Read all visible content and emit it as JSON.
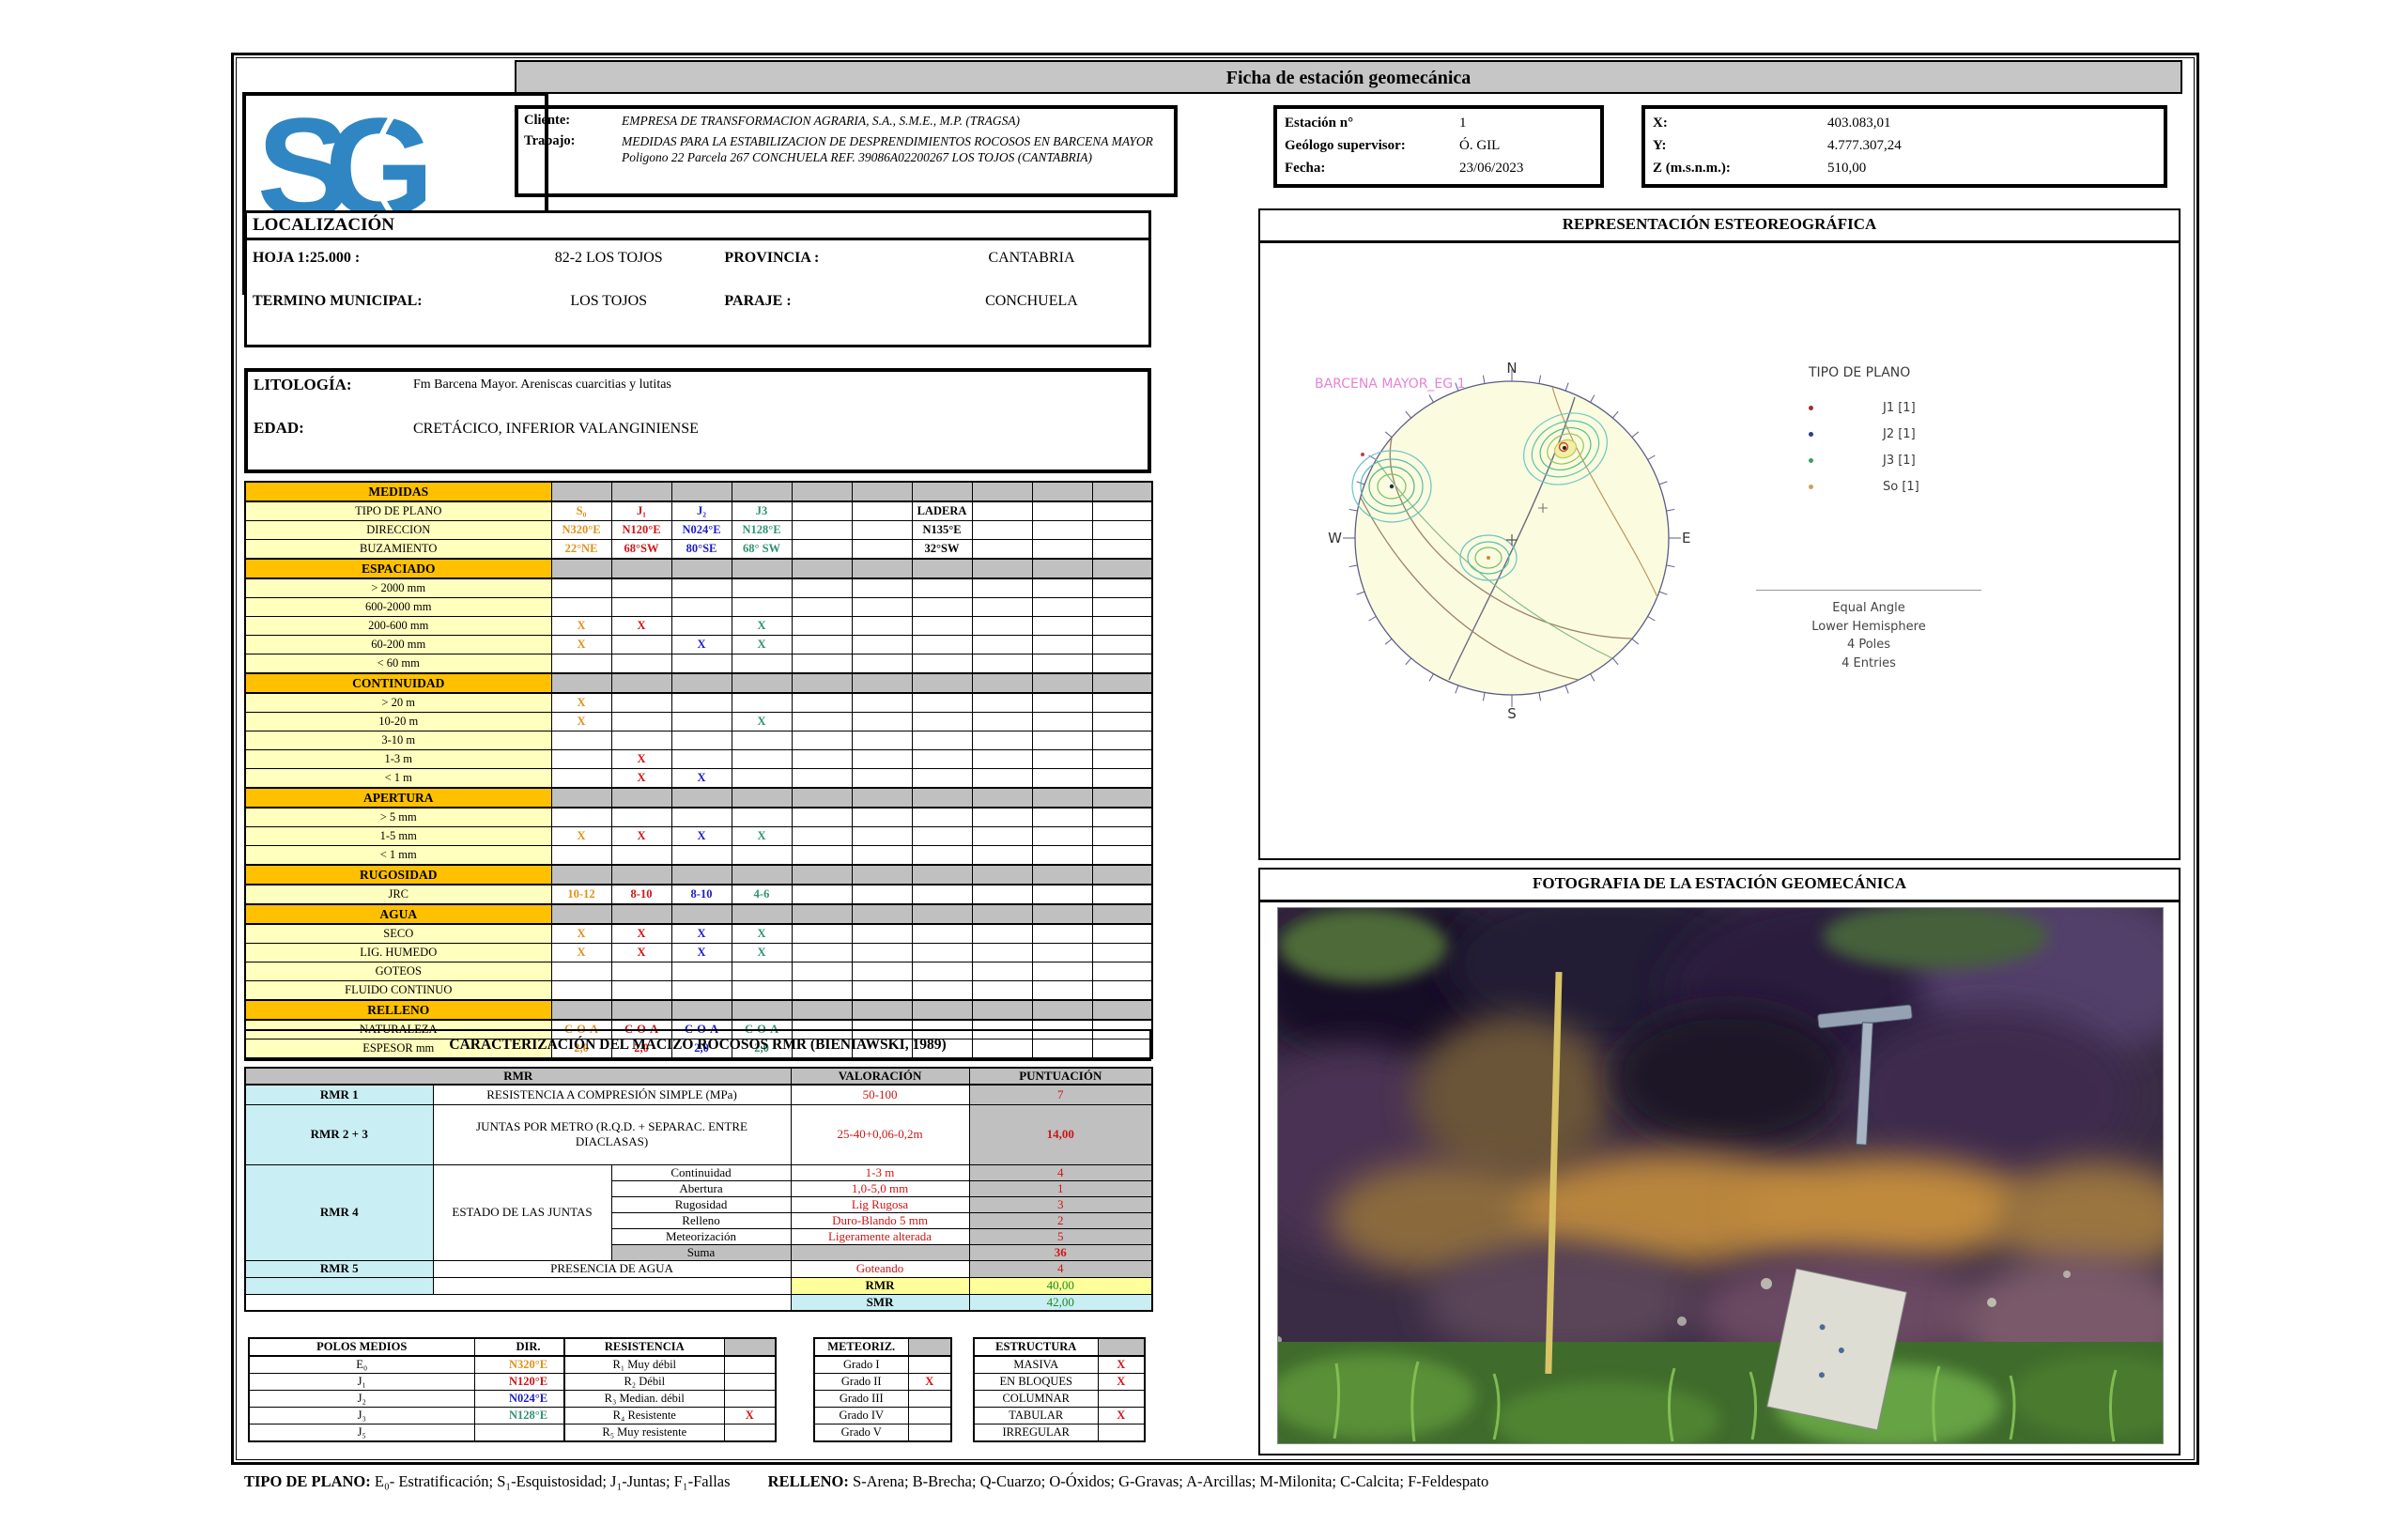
{
  "header": {
    "title": "Ficha de estación geomecánica",
    "logo": {
      "mark": "SG",
      "name": "SONINGEO"
    },
    "client": {
      "cliente_label": "Cliente:",
      "cliente": "EMPRESA DE TRANSFORMACION AGRARIA, S.A., S.M.E., M.P.  (TRAGSA)",
      "trabajo_label": "Trabajo:",
      "trabajo": "MEDIDAS PARA LA ESTABILIZACION DE DESPRENDIMIENTOS ROCOSOS EN BARCENA MAYOR Poligono 22 Parcela 267 CONCHUELA  REF. 39086A02200267 LOS TOJOS (CANTABRIA)"
    },
    "station": [
      [
        "Estación n°",
        "1"
      ],
      [
        "Geólogo supervisor:",
        "Ó. GIL"
      ],
      [
        "Fecha:",
        "23/06/2023"
      ]
    ],
    "coords": [
      [
        "X:",
        "403.083,01"
      ],
      [
        "Y:",
        "4.777.307,24"
      ],
      [
        "Z (m.s.n.m.):",
        "510,00"
      ]
    ]
  },
  "localizacion": {
    "title": "LOCALIZACIÓN",
    "rows": [
      [
        "HOJA 1:25.000 :",
        "82-2 LOS TOJOS",
        "PROVINCIA :",
        "CANTABRIA"
      ],
      [
        "TERMINO MUNICIPAL:",
        "LOS TOJOS",
        "PARAJE :",
        "CONCHUELA"
      ]
    ]
  },
  "litologia": {
    "rows": [
      [
        "LITOLOGÍA:",
        "Fm Barcena Mayor. Areniscas cuarcitias y lutitas"
      ],
      [
        "EDAD:",
        "CRETÁCICO, INFERIOR VALANGINIENSE"
      ]
    ]
  },
  "colors": {
    "o": "#e09018",
    "r": "#cc1616",
    "b": "#1c1cc8",
    "g": "#2e9272",
    "k": "#000000"
  },
  "medidas": {
    "rows": [
      {
        "t": "sec",
        "label": "MEDIDAS"
      },
      {
        "t": "row",
        "label": "TIPO DE PLANO",
        "cells": {
          "0": [
            "S₀",
            "o"
          ],
          "1": [
            "J₁",
            "r"
          ],
          "2": [
            "J₂",
            "b"
          ],
          "3": [
            "J3",
            "g"
          ],
          "6": [
            "LADERA",
            "k"
          ]
        }
      },
      {
        "t": "row",
        "label": "DIRECCION",
        "cells": {
          "0": [
            "N320°E",
            "o"
          ],
          "1": [
            "N120°E",
            "r"
          ],
          "2": [
            "N024°E",
            "b"
          ],
          "3": [
            "N128°E",
            "g"
          ],
          "6": [
            "N135°E",
            "k"
          ]
        }
      },
      {
        "t": "row",
        "label": "BUZAMIENTO",
        "cells": {
          "0": [
            "22°NE",
            "o"
          ],
          "1": [
            "68°SW",
            "r"
          ],
          "2": [
            "80°SE",
            "b"
          ],
          "3": [
            "68° SW",
            "g"
          ],
          "6": [
            "32°SW",
            "k"
          ]
        }
      },
      {
        "t": "sec",
        "label": "ESPACIADO"
      },
      {
        "t": "row",
        "label": "> 2000 mm",
        "cells": {}
      },
      {
        "t": "row",
        "label": "600-2000 mm",
        "cells": {}
      },
      {
        "t": "row",
        "label": "200-600 mm",
        "cells": {
          "0": [
            "X",
            "o"
          ],
          "1": [
            "X",
            "r"
          ],
          "3": [
            "X",
            "g"
          ]
        }
      },
      {
        "t": "row",
        "label": "60-200 mm",
        "cells": {
          "0": [
            "X",
            "o"
          ],
          "2": [
            "X",
            "b"
          ],
          "3": [
            "X",
            "g"
          ]
        }
      },
      {
        "t": "row",
        "label": "< 60 mm",
        "cells": {}
      },
      {
        "t": "sec",
        "label": "CONTINUIDAD"
      },
      {
        "t": "row",
        "label": "> 20 m",
        "cells": {
          "0": [
            "X",
            "o"
          ]
        }
      },
      {
        "t": "row",
        "label": "10-20 m",
        "cells": {
          "0": [
            "X",
            "o"
          ],
          "3": [
            "X",
            "g"
          ]
        }
      },
      {
        "t": "row",
        "label": "3-10 m",
        "cells": {}
      },
      {
        "t": "row",
        "label": "1-3 m",
        "cells": {
          "1": [
            "X",
            "r"
          ]
        }
      },
      {
        "t": "row",
        "label": "< 1 m",
        "cells": {
          "1": [
            "X",
            "r"
          ],
          "2": [
            "X",
            "b"
          ]
        }
      },
      {
        "t": "sec",
        "label": "APERTURA"
      },
      {
        "t": "row",
        "label": "> 5 mm",
        "cells": {}
      },
      {
        "t": "row",
        "label": "1-5 mm",
        "cells": {
          "0": [
            "X",
            "o"
          ],
          "1": [
            "X",
            "r"
          ],
          "2": [
            "X",
            "b"
          ],
          "3": [
            "X",
            "g"
          ]
        }
      },
      {
        "t": "row",
        "label": "< 1 mm",
        "cells": {}
      },
      {
        "t": "sec",
        "label": "RUGOSIDAD"
      },
      {
        "t": "row",
        "label": "JRC",
        "cells": {
          "0": [
            "10-12",
            "o"
          ],
          "1": [
            "8-10",
            "r"
          ],
          "2": [
            "8-10",
            "b"
          ],
          "3": [
            "4-6",
            "g"
          ]
        }
      },
      {
        "t": "sec",
        "label": "AGUA"
      },
      {
        "t": "row",
        "label": "SECO",
        "cells": {
          "0": [
            "X",
            "o"
          ],
          "1": [
            "X",
            "r"
          ],
          "2": [
            "X",
            "b"
          ],
          "3": [
            "X",
            "g"
          ]
        }
      },
      {
        "t": "row",
        "label": "LIG. HUMEDO",
        "cells": {
          "0": [
            "X",
            "o"
          ],
          "1": [
            "X",
            "r"
          ],
          "2": [
            "X",
            "b"
          ],
          "3": [
            "X",
            "g"
          ]
        }
      },
      {
        "t": "row",
        "label": "GOTEOS",
        "cells": {}
      },
      {
        "t": "row",
        "label": "FLUIDO CONTINUO",
        "cells": {}
      },
      {
        "t": "sec",
        "label": "RELLENO"
      },
      {
        "t": "row",
        "label": "NATURALEZA",
        "cells": {
          "0": [
            "C-O-A",
            "o"
          ],
          "1": [
            "C-O-A",
            "r"
          ],
          "2": [
            "C-O-A",
            "b"
          ],
          "3": [
            "C-O-A",
            "g"
          ]
        }
      },
      {
        "t": "row",
        "label": "ESPESOR mm",
        "cells": {
          "0": [
            "2,0",
            "o"
          ],
          "1": [
            "2,0",
            "r"
          ],
          "2": [
            "2,0",
            "b"
          ],
          "3": [
            "2,0",
            "g"
          ]
        }
      }
    ]
  },
  "rmr": {
    "section_title": "CARACTERIZACIÓN DEL MACIZO ROCOSOS RMR (BIENIAWSKI, 1989)",
    "header": {
      "rmr": "RMR",
      "valoracion": "VALORACIÓN",
      "puntuacion": "PUNTUACIÓN"
    },
    "r1": {
      "label": "RMR 1",
      "desc": "RESISTENCIA A COMPRESIÓN SIMPLE (MPa)",
      "val": "50-100",
      "pts": "7"
    },
    "r23": {
      "label": "RMR 2 + 3",
      "desc": "JUNTAS POR METRO (R.Q.D. + SEPARAC. ENTRE DIACLASAS)",
      "val": "25-40+0,06-0,2m",
      "pts": "14,00"
    },
    "r4": {
      "label": "RMR 4",
      "desc": "ESTADO DE LAS JUNTAS",
      "subs": [
        {
          "n": "Continuidad",
          "v": "1-3 m",
          "p": "4"
        },
        {
          "n": "Abertura",
          "v": "1,0-5,0 mm",
          "p": "1"
        },
        {
          "n": "Rugosidad",
          "v": "Lig Rugosa",
          "p": "3"
        },
        {
          "n": "Relleno",
          "v": "Duro-Blando  5 mm",
          "p": "2"
        },
        {
          "n": "Meteorización",
          "v": "Ligeramente alterada",
          "p": "5"
        },
        {
          "n": "Suma",
          "v": "",
          "p": "36"
        }
      ]
    },
    "r5": {
      "label": "RMR 5",
      "desc": "PRESENCIA DE AGUA",
      "val": "Goteando",
      "pts": "4"
    },
    "totals": [
      {
        "name": "RMR",
        "value": "40,00"
      },
      {
        "name": "SMR",
        "value": "42,00"
      }
    ]
  },
  "bottom": {
    "polos": {
      "headers": [
        "POLOS MEDIOS",
        "DIR.",
        "BUZ."
      ],
      "rows": [
        {
          "label": "E₀",
          "dir": "N320°E",
          "buz": "22°NE",
          "c": "o"
        },
        {
          "label": "J₁",
          "dir": "N120°E",
          "buz": "68°SW",
          "c": "r"
        },
        {
          "label": "J₂",
          "dir": "N024°E",
          "buz": "80°SE",
          "c": "b"
        },
        {
          "label": "J₃",
          "dir": "N128°E",
          "buz": "68° SW",
          "c": "g"
        },
        {
          "label": "J₅",
          "dir": "",
          "buz": "",
          "c": ""
        }
      ]
    },
    "resistencia": {
      "header": "RESISTENCIA",
      "rows": [
        {
          "label": "R₁ Muy débil",
          "mark": ""
        },
        {
          "label": "R₂ Débil",
          "mark": ""
        },
        {
          "label": "R₃ Median. débil",
          "mark": ""
        },
        {
          "label": "R₄ Resistente",
          "mark": "X"
        },
        {
          "label": "R₅ Muy resistente",
          "mark": ""
        }
      ]
    },
    "meteoriz": {
      "header": "METEORIZ.",
      "rows": [
        {
          "label": "Grado I",
          "mark": ""
        },
        {
          "label": "Grado II",
          "mark": "X"
        },
        {
          "label": "Grado III",
          "mark": ""
        },
        {
          "label": "Grado IV",
          "mark": ""
        },
        {
          "label": "Grado V",
          "mark": ""
        }
      ]
    },
    "estructura": {
      "header": "ESTRUCTURA",
      "rows": [
        {
          "label": "MASIVA",
          "mark": "X"
        },
        {
          "label": "EN BLOQUES",
          "mark": "X"
        },
        {
          "label": "COLUMNAR",
          "mark": ""
        },
        {
          "label": "TABULAR",
          "mark": "X"
        },
        {
          "label": "IRREGULAR",
          "mark": ""
        }
      ]
    }
  },
  "stereonet": {
    "title": "REPRESENTACIÓN ESTEOREOGRÁFICA",
    "plot_label": "BARCENA MAYOR_EG 1",
    "compass": {
      "n": "N",
      "e": "E",
      "s": "S",
      "w": "W"
    },
    "legend_title": "TIPO DE PLANO",
    "legend": [
      {
        "label": "J1 [1]",
        "color": "#a03028"
      },
      {
        "label": "J2 [1]",
        "color": "#2c3c88"
      },
      {
        "label": "J3 [1]",
        "color": "#3ca060"
      },
      {
        "label": "So [1]",
        "color": "#d0a060"
      }
    ],
    "footnote": [
      "Equal Angle",
      "Lower Hemisphere",
      "4 Poles",
      "4 Entries"
    ]
  },
  "photo": {
    "title": "FOTOGRAFIA DE LA ESTACIÓN GEOMECÁNICA"
  },
  "footer": {
    "planes_label": "TIPO DE PLANO:",
    "planes": "E₀- Estratificación; S₁-Esquistosidad; J₁-Juntas; F₁-Fallas",
    "relleno_label": "RELLENO:",
    "relleno": "S-Arena; B-Brecha; Q-Cuarzo; O-Óxidos; G-Gravas; A-Arcillas; M-Milonita; C-Calcita; F-Feldespato"
  }
}
